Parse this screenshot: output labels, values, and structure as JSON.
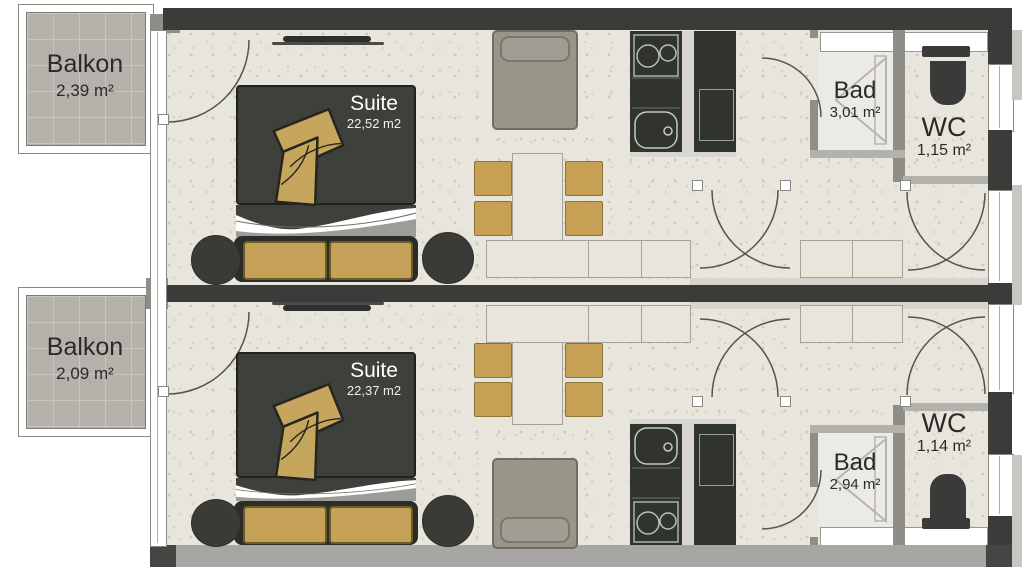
{
  "title": "Apartment floor plan",
  "units": {
    "top": {
      "balcony": {
        "name": "Balkon",
        "area": "2,39 m²"
      },
      "suite": {
        "name": "Suite",
        "area": "22,52 m2"
      },
      "bath": {
        "name": "Bad",
        "area": "3,01 m²"
      },
      "wc": {
        "name": "WC",
        "area": "1,15 m²"
      }
    },
    "bottom": {
      "balcony": {
        "name": "Balkon",
        "area": "2,09 m²"
      },
      "suite": {
        "name": "Suite",
        "area": "22,37 m2"
      },
      "bath": {
        "name": "Bad",
        "area": "2,94 m²"
      },
      "wc": {
        "name": "WC",
        "area": "1,14 m²"
      }
    }
  },
  "colors": {
    "wall_dark": "#3b3b39",
    "wall_gray": "#8f8d87",
    "wall_bottom_band": "#a8a6a2",
    "floor_speckled": "#e8e5dc",
    "balcony_tile": "#b4b1ab",
    "wood_tan": "#c4a157",
    "bed_duvet": "#3e413b",
    "kitchen_cabinet": "#31342e",
    "light_furniture": "#e9e5da",
    "armchair_gray": "#999689"
  }
}
